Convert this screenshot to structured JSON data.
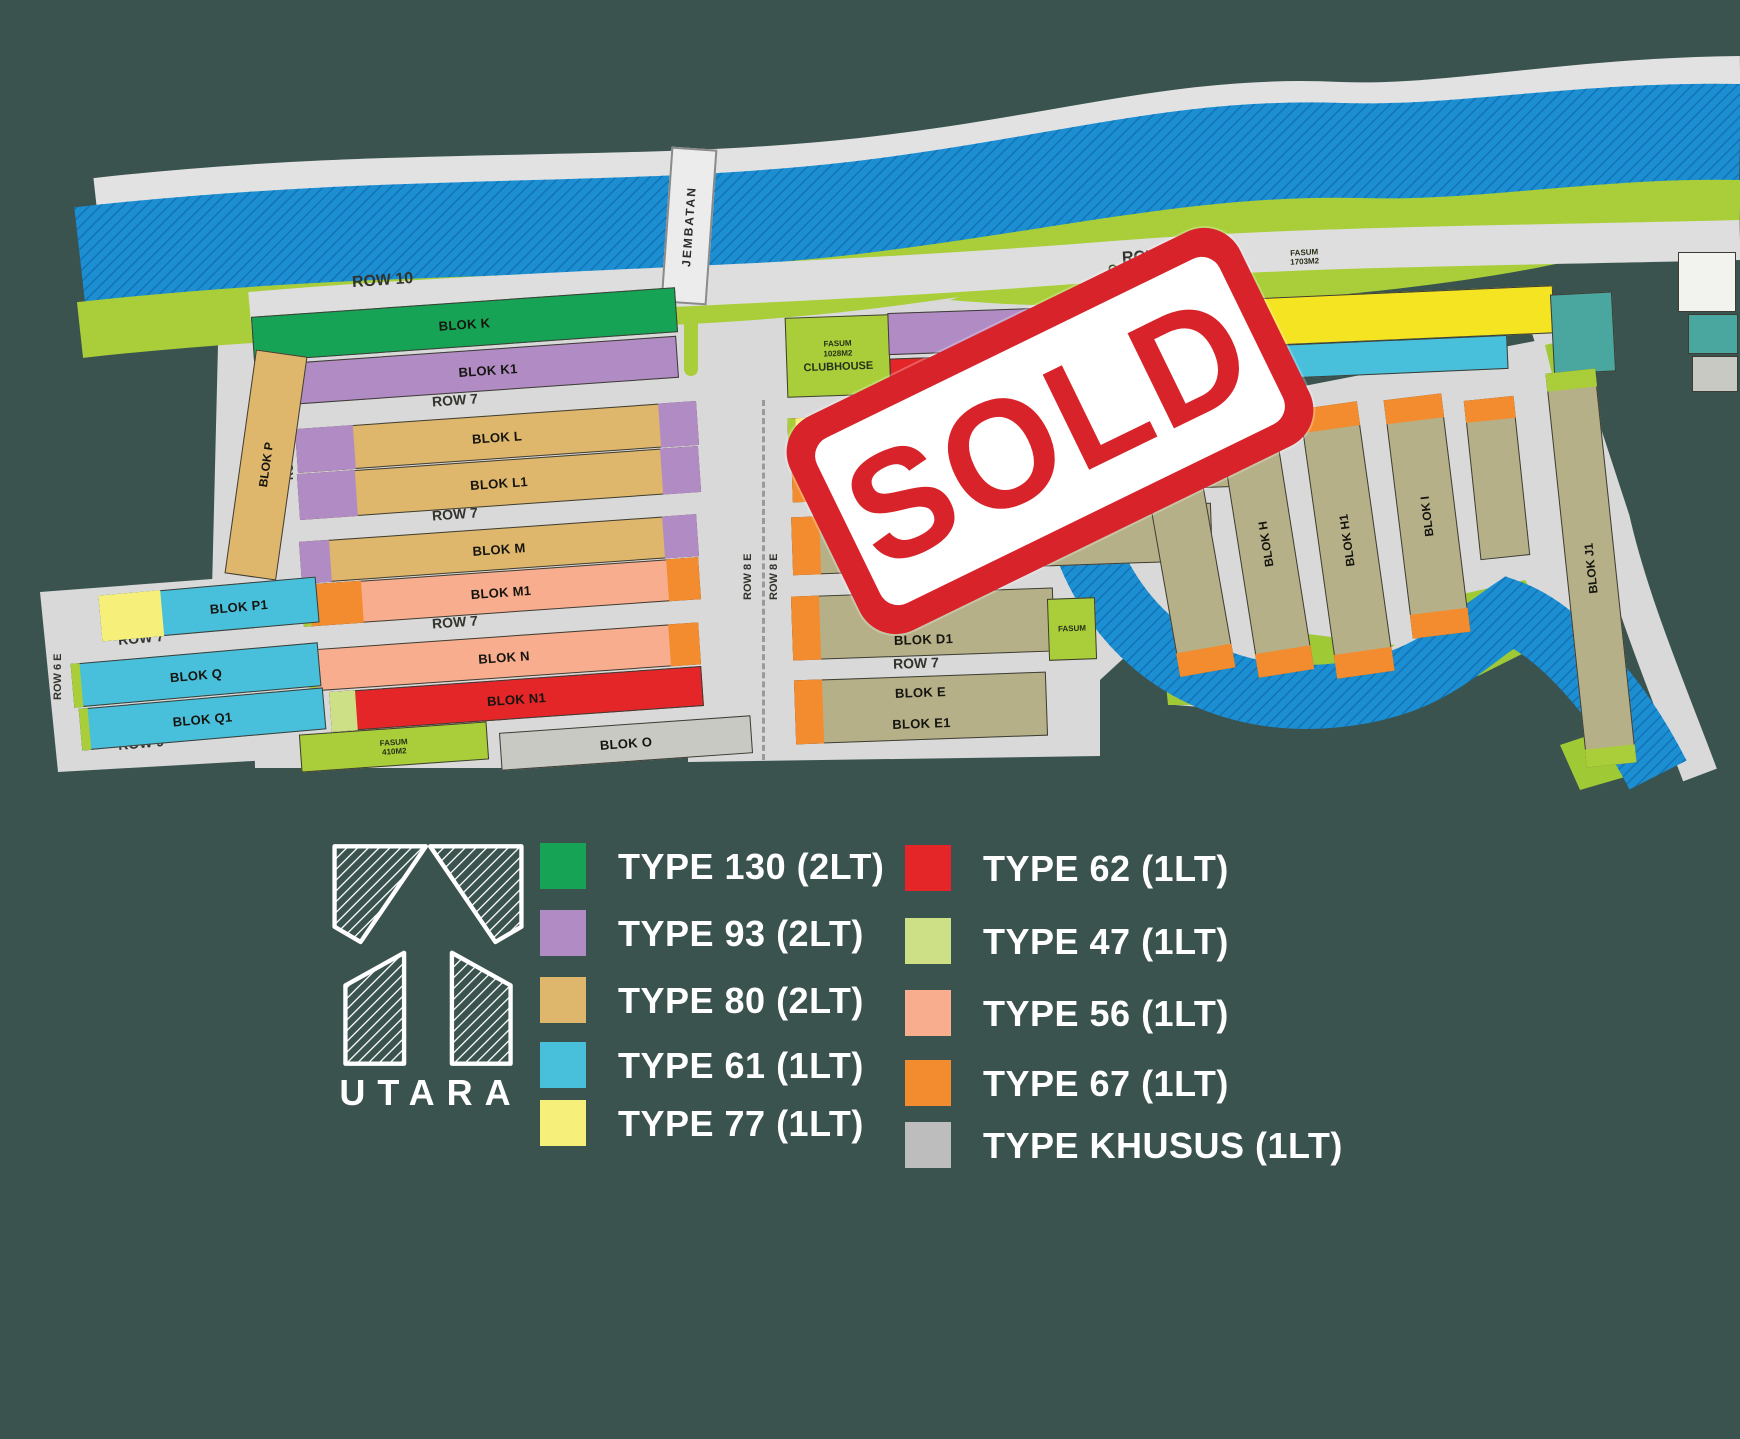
{
  "map": {
    "bridge": "JEMBATAN",
    "garden_park": "GARDEN PARK",
    "garden_fasum1": "FASUM",
    "garden_fasum2": "1703M2",
    "clubhouse": {
      "fasum1": "FASUM",
      "fasum2": "1028M2",
      "label": "CLUBHOUSE"
    },
    "fasum_o1": "FASUM",
    "fasum_o2": "410M2",
    "fasum_e": "FASUM",
    "rows": {
      "r10": "ROW 10",
      "r7": "ROW 7",
      "r9": "ROW 9",
      "r6": "ROW 6 E",
      "r8": "ROW 8 E"
    },
    "blocks": {
      "k": "BLOK K",
      "k1": "BLOK K1",
      "l": "BLOK L",
      "l1": "BLOK L1",
      "m": "BLOK M",
      "m1": "BLOK M1",
      "n": "BLOK N",
      "n1": "BLOK N1",
      "o": "BLOK O",
      "p": "BLOK P",
      "p1": "BLOK P1",
      "q": "BLOK Q",
      "q1": "BLOK Q1",
      "a": "BLOK A",
      "b": "BLOK B",
      "c": "BLOK C",
      "d": "BLOK D",
      "d1": "BLOK D1",
      "e": "BLOK E",
      "e1": "BLOK E1",
      "h": "BLOK H",
      "h1": "BLOK H1",
      "i": "BLOK I",
      "j1": "BLOK J1"
    }
  },
  "stamp": {
    "label": "SOLD"
  },
  "compass": {
    "label": "UTARA"
  },
  "legend": {
    "col1": [
      {
        "label": "TYPE 130 (2LT)",
        "color": "#17a355"
      },
      {
        "label": "TYPE 93 (2LT)",
        "color": "#b18bc3"
      },
      {
        "label": "TYPE 80 (2LT)",
        "color": "#deb66c"
      },
      {
        "label": "TYPE 61 (1LT)",
        "color": "#48bfdb"
      },
      {
        "label": "TYPE 77 (1LT)",
        "color": "#f6f07a"
      }
    ],
    "col2": [
      {
        "label": "TYPE 62 (1LT)",
        "color": "#e52629"
      },
      {
        "label": "TYPE 47 (1LT)",
        "color": "#cde085"
      },
      {
        "label": "TYPE 56 (1LT)",
        "color": "#f8ad8e"
      },
      {
        "label": "TYPE 67 (1LT)",
        "color": "#f28c2e"
      },
      {
        "label": "TYPE KHUSUS (1LT)",
        "color": "#bdbdbd"
      }
    ]
  }
}
